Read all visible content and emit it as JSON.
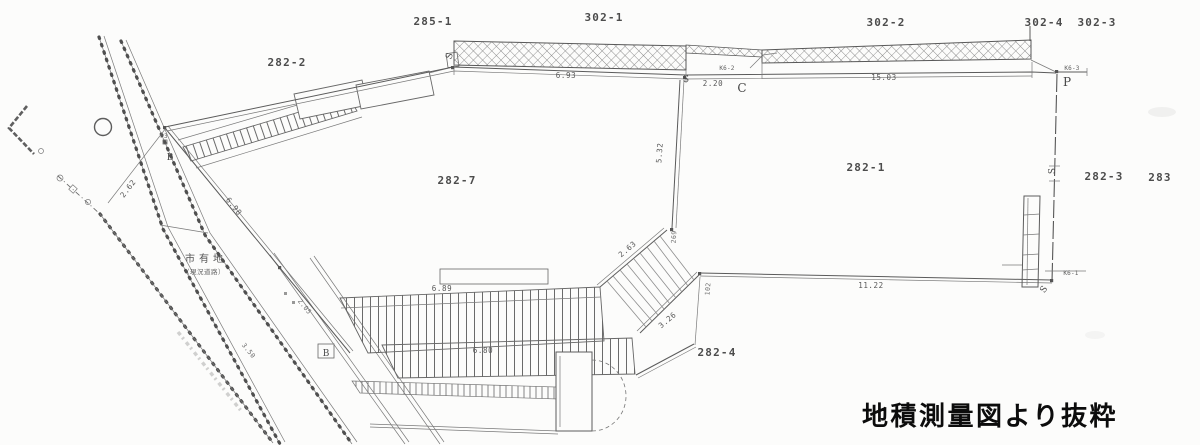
{
  "caption": "地積測量図より抜粋",
  "parcels": {
    "p285_1": "285-1",
    "p302_1": "302-1",
    "p302_2": "302-2",
    "p302_4": "302-4",
    "p302_3": "302-3",
    "p282_2": "282-2",
    "p282_7": "282-7",
    "p282_1": "282-1",
    "p282_3": "282-3",
    "p283": "283",
    "p282_4": "282-4"
  },
  "areas": {
    "city_land": "市有地",
    "city_land_note": "（現況道路）"
  },
  "measurements": {
    "m693": "6.93",
    "m220": "2.20",
    "m1503": "15.03",
    "m532": "5.32",
    "m263": "2.63",
    "m326": "3.26",
    "m1122": "11.22",
    "m689": "6.89",
    "m680": "6.80",
    "m262": "2.62",
    "m698": "6.98",
    "m205": "2.05",
    "m350": "3.50",
    "m269": "269",
    "m102": "102"
  },
  "markers": {
    "s1": "S",
    "s2": "S",
    "s3": "S",
    "s4": "S",
    "c": "C",
    "p": "P",
    "p3": "P3",
    "b1": "B",
    "b2": "B",
    "k61": "K6-1",
    "k62": "K6-2",
    "k63": "K6-3"
  }
}
